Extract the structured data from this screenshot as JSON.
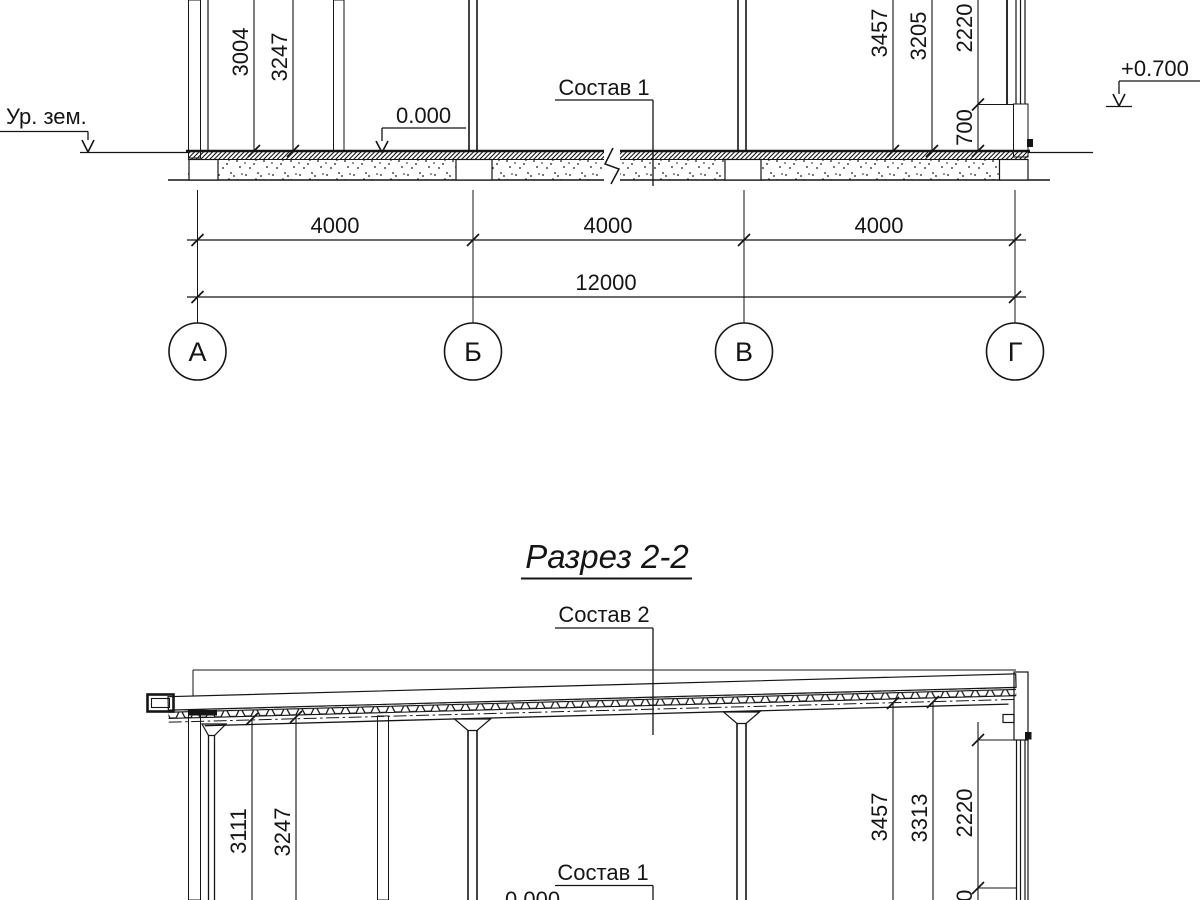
{
  "section1": {
    "ground_level_label": "Ур. зем.",
    "zero_mark": "0.000",
    "layers1_label": "Состав 1",
    "elevation_mark": "+0.700",
    "dim_3004": "3004",
    "dim_3247": "3247",
    "dim_3457": "3457",
    "dim_3205": "3205",
    "dim_2220": "2220",
    "dim_700": "700",
    "span_dims": [
      "4000",
      "4000",
      "4000"
    ],
    "total_dim": "12000",
    "axis_labels": [
      "А",
      "Б",
      "В",
      "Г"
    ]
  },
  "section2": {
    "title": "Разрез 2-2",
    "layers2_label": "Состав 2",
    "layers1_label": "Состав 1",
    "zero_mark": "0.000",
    "dim_3111": "3111",
    "dim_3247": "3247",
    "dim_3457": "3457",
    "dim_3313": "3313",
    "dim_2220": "2220",
    "dim_700": "700"
  },
  "colors": {
    "ink": "#151515",
    "paper": "#ffffff"
  }
}
